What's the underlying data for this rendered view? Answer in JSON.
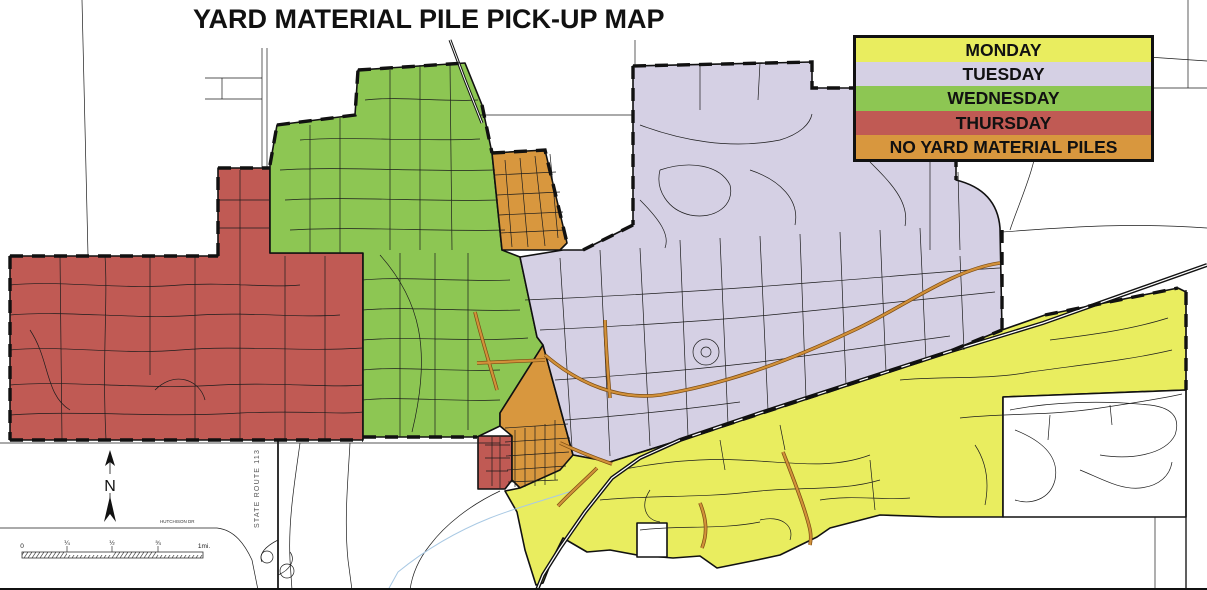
{
  "title": "YARD MATERIAL PILE PICK-UP MAP",
  "legend": {
    "items": [
      {
        "label": "MONDAY",
        "color": "#e9ed5f"
      },
      {
        "label": "TUESDAY",
        "color": "#d5d0e4"
      },
      {
        "label": "WEDNESDAY",
        "color": "#8dc653"
      },
      {
        "label": "THURSDAY",
        "color": "#c05a54"
      },
      {
        "label": "NO YARD MATERIAL PILES",
        "color": "#d8973e"
      }
    ]
  },
  "map": {
    "zone_colors": {
      "monday": "#e9ed5f",
      "tuesday": "#d5d0e4",
      "wednesday": "#8dc653",
      "thursday": "#c05a54",
      "no_piles": "#d8973e"
    },
    "highlight_road_color": "#d2913a",
    "highlight_road_edge": "#7a4a12",
    "creek_color": "#a9c9e4",
    "street_color": "#1c1c1c",
    "labels": {
      "state_route": "STATE ROUTE 113",
      "hutchison": "HUTCHISON DR",
      "north": "N"
    },
    "scale_bar": {
      "labels": [
        "0",
        "¼",
        "½",
        "¾",
        "1mi."
      ]
    }
  }
}
